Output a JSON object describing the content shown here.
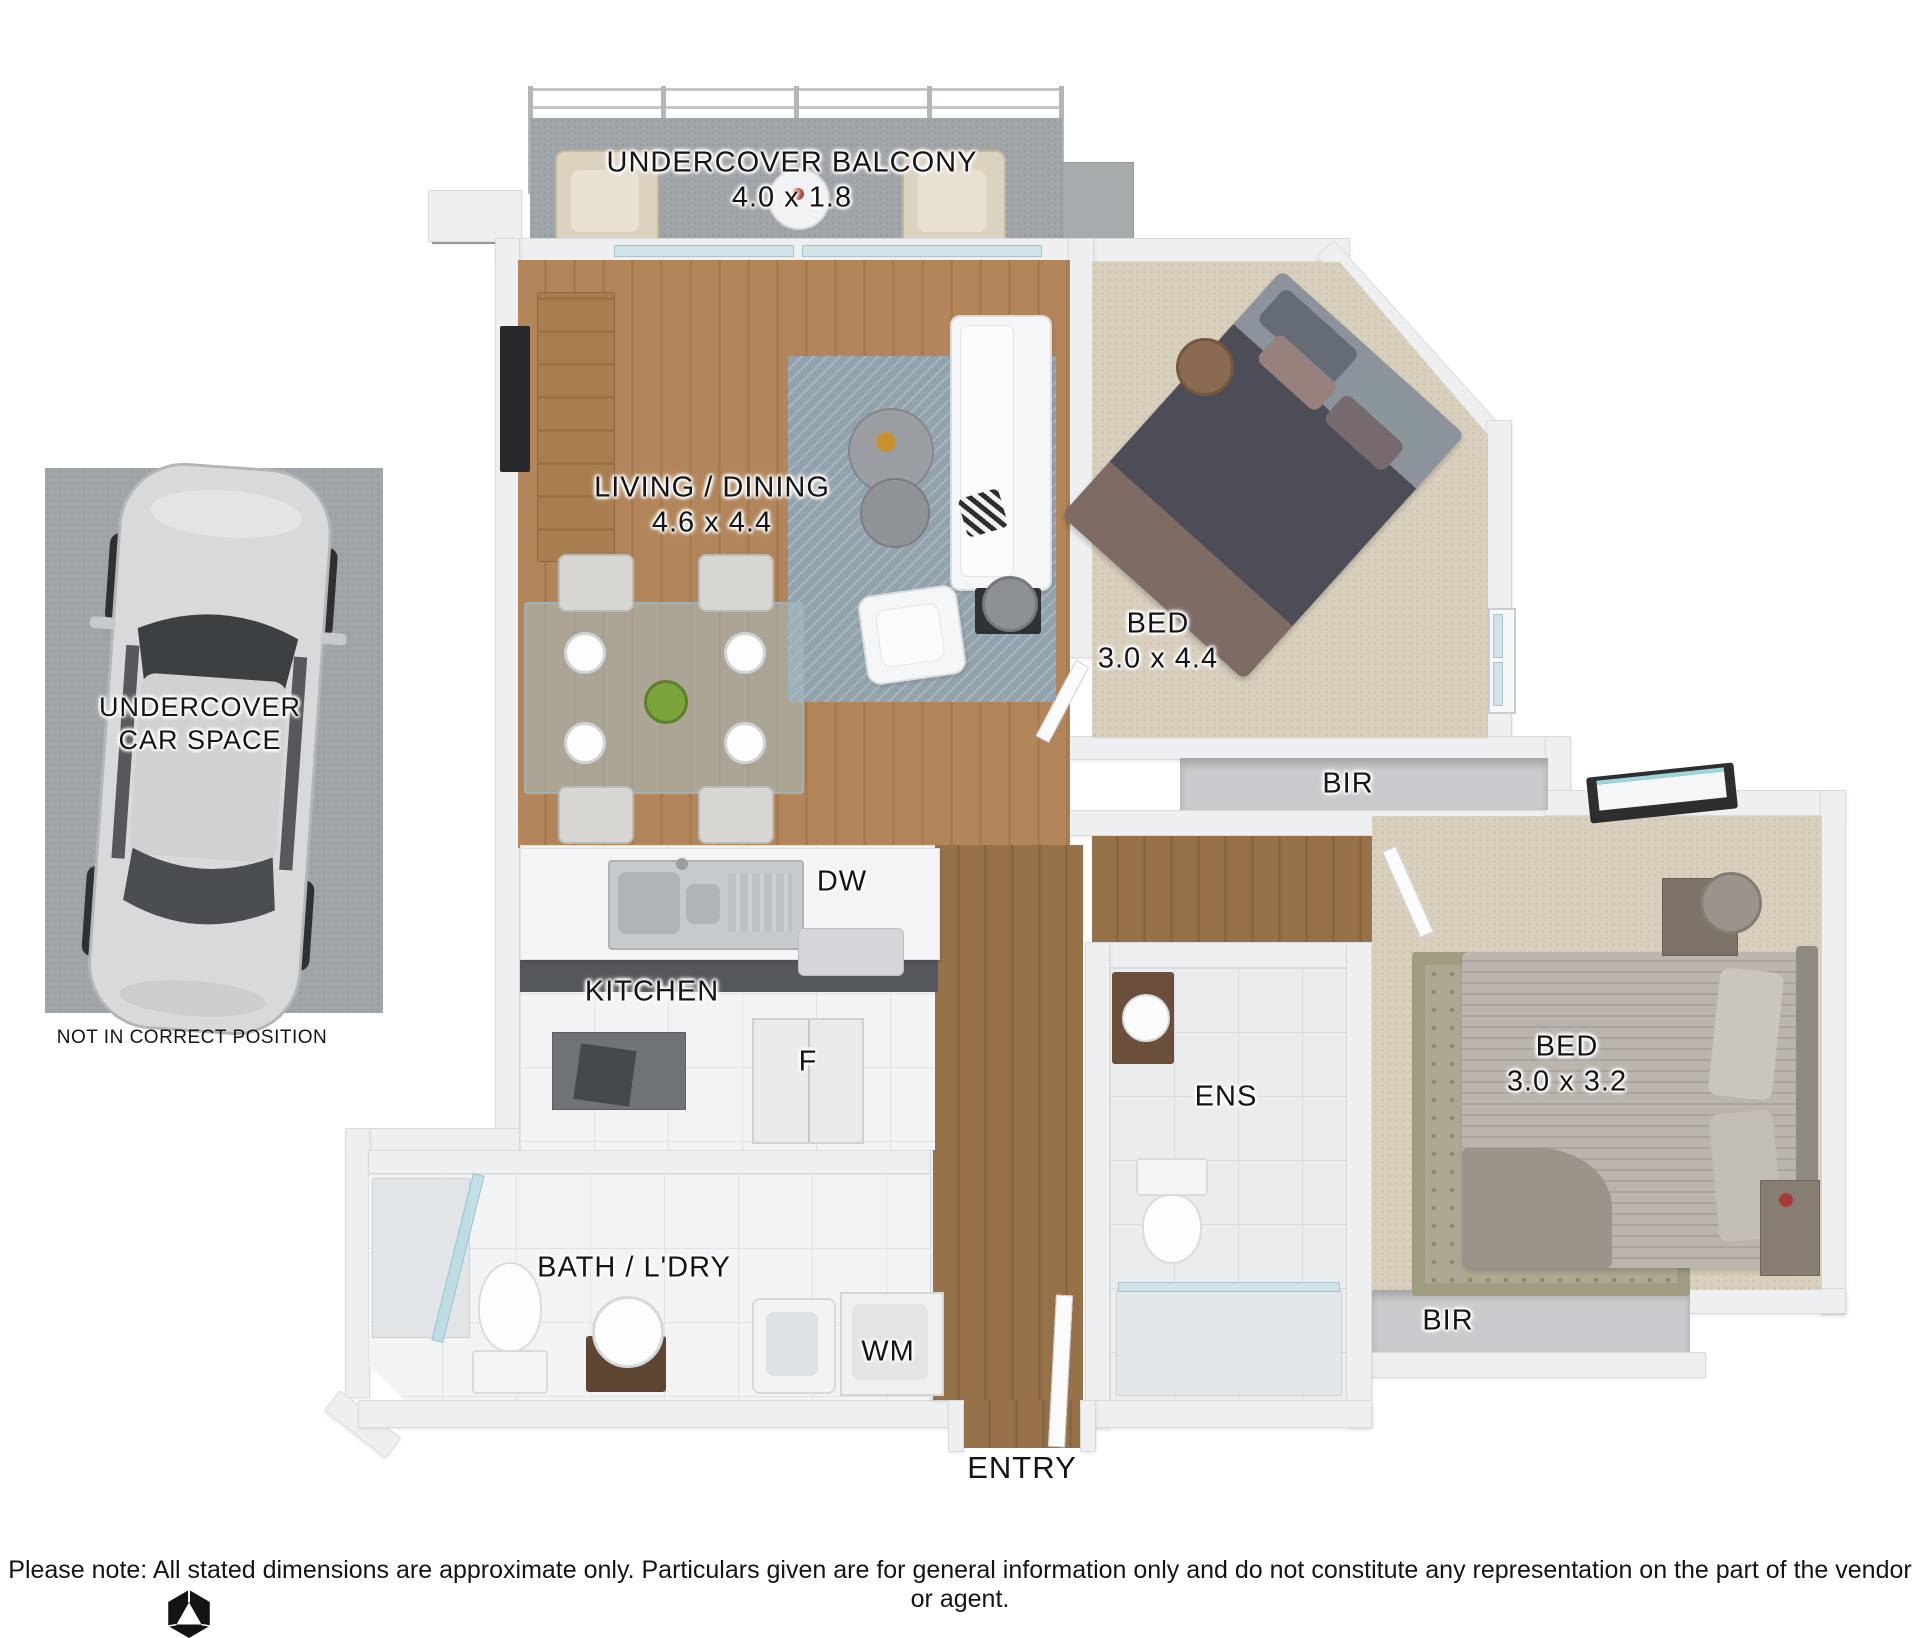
{
  "rooms": {
    "balcony": {
      "name": "UNDERCOVER BALCONY",
      "dims": "4.0 x 1.8"
    },
    "living": {
      "name": "LIVING / DINING",
      "dims": "4.6 x 4.4"
    },
    "bed1": {
      "name": "BED",
      "dims": "3.0 x 4.4"
    },
    "bir1": {
      "name": "BIR"
    },
    "kitchen": {
      "name": "KITCHEN"
    },
    "bath": {
      "name": "BATH / L'DRY"
    },
    "ens": {
      "name": "ENS"
    },
    "bed2": {
      "name": "BED",
      "dims": "3.0 x 3.2"
    },
    "bir2": {
      "name": "BIR"
    },
    "entry": {
      "name": "ENTRY"
    }
  },
  "appliances": {
    "dishwasher": "DW",
    "fridge": "F",
    "washing_machine": "WM"
  },
  "car_space": {
    "name": "UNDERCOVER CAR SPACE",
    "note": "NOT IN CORRECT POSITION"
  },
  "footer": {
    "disclaimer": "Please note: All stated dimensions are approximate only. Particulars given are for general information only and do not constitute any representation on the part of the vendor or agent."
  },
  "colors": {
    "wood_floor": "#ab7f52",
    "hall_wood": "#916c46",
    "carpet": "#d8cfbd",
    "wall": "#edeff1",
    "concrete": "#a0a5a9",
    "living_rug": "#93a3ad",
    "bed1_duvet": "#4d4d57",
    "logo": "#141414"
  }
}
